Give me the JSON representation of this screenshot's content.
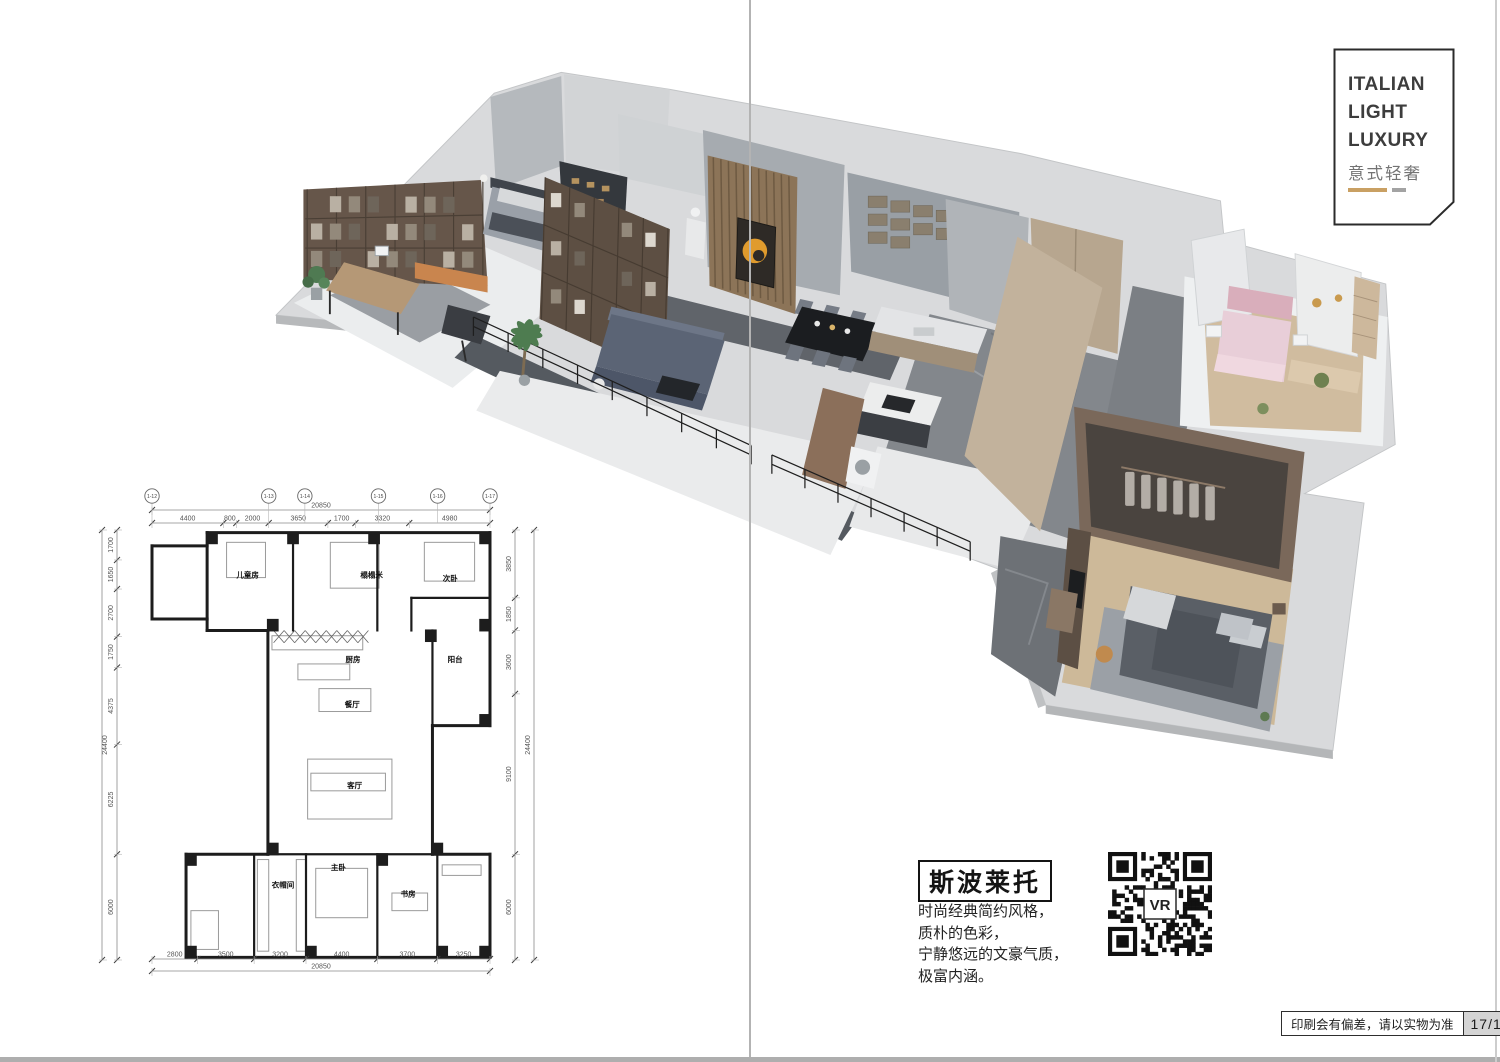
{
  "title_block": {
    "line1": "ITALIAN",
    "line2": "LIGHT",
    "line3": "LUXURY",
    "subtitle": "意式轻奢"
  },
  "product": {
    "name": "斯波莱托",
    "description_lines": [
      "时尚经典简约风格，",
      "质朴的色彩，",
      "宁静悠远的文豪气质，",
      "极富内涵。"
    ],
    "vr_label": "VR"
  },
  "footer": {
    "disclaimer": "印刷会有偏差，请以实物为准",
    "page_number": "17/18"
  },
  "floorplan": {
    "total_width_mm": 20850,
    "total_height_mm": 24400,
    "top_total": "20850",
    "bottom_total": "20850",
    "left_total": "24400",
    "right_total": "24400",
    "top_segments": [
      4400,
      800,
      2000,
      3650,
      1700,
      3320,
      4980
    ],
    "bottom_segments": [
      2800,
      3500,
      3200,
      4400,
      3700,
      3250
    ],
    "left_segments": [
      1700,
      1650,
      2700,
      1750,
      4375,
      6225,
      6000
    ],
    "right_segments": [
      3850,
      1850,
      3600,
      9100,
      6000
    ],
    "grid_bubbles": [
      {
        "label": "1-12",
        "pos": 0
      },
      {
        "label": "1-13",
        "pos": 7200
      },
      {
        "label": "1-14",
        "pos": 9430
      },
      {
        "label": "1-15",
        "pos": 13970
      },
      {
        "label": "1-16",
        "pos": 17620
      },
      {
        "label": "1-17",
        "pos": 20850
      }
    ],
    "rooms": [
      {
        "label": "儿童房",
        "x": 5900,
        "y": 2700
      },
      {
        "label": "榻榻米",
        "x": 13550,
        "y": 2700
      },
      {
        "label": "次卧",
        "x": 18400,
        "y": 2900
      },
      {
        "label": "厨房",
        "x": 12400,
        "y": 7500
      },
      {
        "label": "阳台",
        "x": 18700,
        "y": 7500
      },
      {
        "label": "餐厅",
        "x": 12350,
        "y": 10050
      },
      {
        "label": "客厅",
        "x": 12500,
        "y": 14650
      },
      {
        "label": "衣帽间",
        "x": 8080,
        "y": 20300
      },
      {
        "label": "主卧",
        "x": 11500,
        "y": 19300
      },
      {
        "label": "书房",
        "x": 15800,
        "y": 20800
      }
    ]
  },
  "theme": {
    "accent_gold": "#c9a063",
    "ink": "#2f2f2f",
    "line_gray": "#a3a3a3"
  }
}
